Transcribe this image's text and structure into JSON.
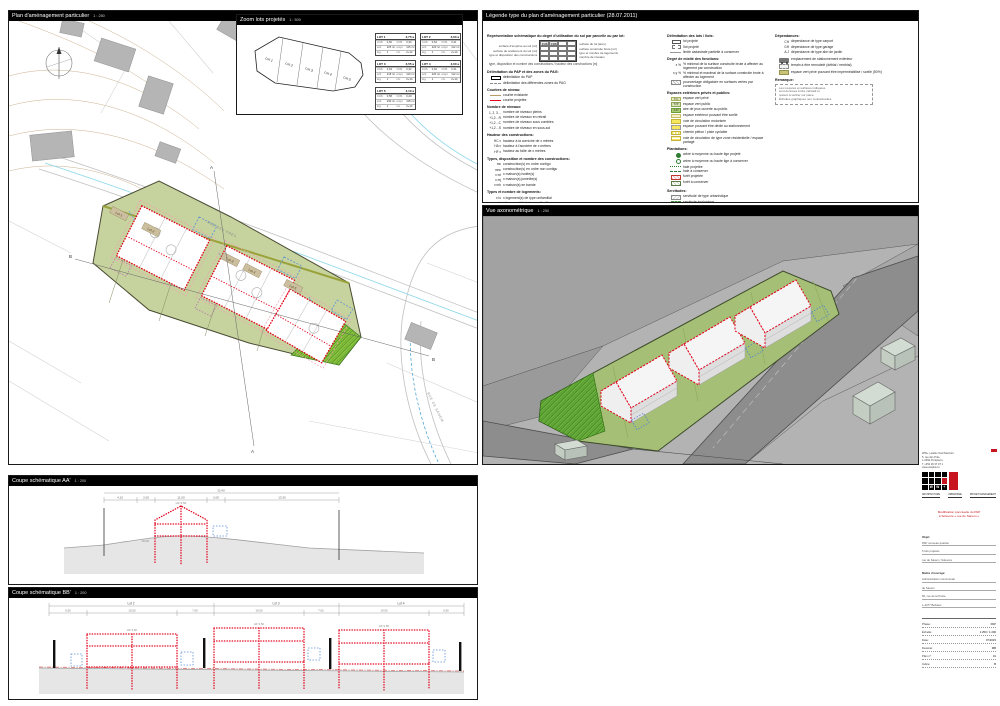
{
  "panels": {
    "plan": {
      "title": "Plan d'aménagement particulier",
      "scale": "1 : 250"
    },
    "zoom": {
      "title": "Zoom lots projetés",
      "scale": "1 : 500"
    },
    "legend": {
      "title": "Légende type du plan d'aménagement particulier (28.07.2011)"
    },
    "axo": {
      "title": "Vue axonométrique",
      "scale": "1 : 250"
    },
    "coupeA": {
      "title": "Coupe schématique AA'",
      "scale": "1 : 200"
    },
    "coupeB": {
      "title": "Coupe schématique BB'",
      "scale": "1 : 200"
    }
  },
  "plan": {
    "north": "N",
    "street_top": "RUE DES PRÉS",
    "street_right": "RUE DE SANEM",
    "lots": [
      "Lot 1",
      "Lot 2",
      "Lot 3",
      "Lot 4",
      "Lot 5"
    ],
    "sectionA": "A",
    "sectionB": "B"
  },
  "zoom_lots": {
    "labels": [
      "Lot 1",
      "Lot 2",
      "Lot 3",
      "Lot 4",
      "Lot 5"
    ]
  },
  "lot_tables": [
    {
      "title": "LOT 1",
      "area": "3,75 a",
      "rows": [
        [
          "CUS",
          "0,60",
          "COS",
          "0,30"
        ],
        [
          "scb",
          "225 m²",
          "empr.",
          "115 m²"
        ],
        [
          "log.",
          "1",
          "niv.",
          "2+1C"
        ]
      ]
    },
    {
      "title": "LOT 2",
      "area": "3,60 a",
      "rows": [
        [
          "CUS",
          "0,62",
          "COS",
          "0,31"
        ],
        [
          "scb",
          "220 m²",
          "empr.",
          "112 m²"
        ],
        [
          "log.",
          "1",
          "niv.",
          "2+1C"
        ]
      ]
    },
    {
      "title": "LOT 3",
      "area": "3,55 a",
      "rows": [
        [
          "CUS",
          "0,63",
          "COS",
          "0,32"
        ],
        [
          "scb",
          "218 m²",
          "empr.",
          "110 m²"
        ],
        [
          "log.",
          "1",
          "niv.",
          "2+1C"
        ]
      ]
    },
    {
      "title": "LOT 4",
      "area": "3,60 a",
      "rows": [
        [
          "CUS",
          "0,62",
          "COS",
          "0,31"
        ],
        [
          "scb",
          "220 m²",
          "empr.",
          "112 m²"
        ],
        [
          "log.",
          "1",
          "niv.",
          "2+1C"
        ]
      ]
    },
    {
      "title": "LOT 5",
      "area": "4,10 a",
      "rows": [
        [
          "CUS",
          "0,58",
          "COS",
          "0,29"
        ],
        [
          "scb",
          "230 m²",
          "empr.",
          "118 m²"
        ],
        [
          "log.",
          "1",
          "niv.",
          "2+1C"
        ]
      ]
    }
  ],
  "legend": {
    "columns": [
      [
        {
          "h": "Représentation schématique du degré d'utilisation du sol par parcelle ou par lot:",
          "table": {
            "left": [
              "surface d'emprise au sol [m²]",
              "surface de scellement du sol [m²]",
              "type et disposition des constructions"
            ],
            "right": [
              "surface du lot [ares]",
              "surface construite brute [m²]",
              "type et nombre de logements",
              "nombre de niveaux"
            ],
            "h1": "CUS",
            "h2": "COS"
          },
          "note": "type, disposition et nombre des constructions / hauteur des constructions [m]"
        },
        {
          "h": "Délimitation du PAP et des zones du PAG:",
          "items": [
            {
              "sw": "blackbox",
              "label": "délimitation du PAP"
            },
            {
              "sw": "graydash",
              "label": "délimitation des différentes zones du PAG"
            }
          ]
        },
        {
          "h": "Courbes de niveau:",
          "items": [
            {
              "sw": "tan",
              "label": "courbe existante"
            },
            {
              "sw": "red",
              "label": "courbe projetée"
            }
          ]
        },
        {
          "h": "Nombre de niveaux:",
          "items": [
            {
              "ab": "1, 2, 3…",
              "label": "nombre de niveaux pleins"
            },
            {
              "ab": "+1,2…R",
              "label": "nombre de niveaux en retrait"
            },
            {
              "ab": "+1,2…C",
              "label": "nombre de niveaux sous combles"
            },
            {
              "ab": "+1,2…S",
              "label": "nombre de niveaux en sous-sol"
            }
          ]
        },
        {
          "h": "Hauteur des constructions:",
          "items": [
            {
              "ab": "HC x",
              "label": "hauteur à la corniche de x mètres"
            },
            {
              "ab": "HA x",
              "label": "hauteur à l'acrotère de x mètres"
            },
            {
              "ab": "HF x",
              "label": "hauteur au faîte de x mètres"
            }
          ]
        },
        {
          "h": "Types, disposition et nombre des constructions:",
          "items": [
            {
              "ab": "mc",
              "label": "construction(s) en ordre contigu"
            },
            {
              "ab": "mnc",
              "label": "construction(s) en ordre non contigu"
            },
            {
              "ab": "x mi",
              "label": "x maison(s) isolée(s)"
            },
            {
              "ab": "x mj",
              "label": "x maison(s) jumelée(s)"
            },
            {
              "ab": "x mb",
              "label": "x maison(s) en bande"
            }
          ]
        },
        {
          "h": "Types et nombre de logements:",
          "items": [
            {
              "ab": "x lu",
              "label": "x logement(s) de type unifamilial"
            },
            {
              "ab": "x lc",
              "label": "x logement(s) de type collectif"
            },
            {
              "ab": "x ls",
              "label": "x logement(s) de type studio"
            }
          ]
        },
        {
          "h": "Formes de toiture:",
          "items": [
            {
              "ab": "tp",
              "label": "toiture plate"
            },
            {
              "ab": "tv (x°)",
              "label": "toiture à versants, degré d'inclinaison"
            },
            {
              "sw": "arrow",
              "label": "orientation du faîte"
            }
          ]
        },
        {
          "h": "Gabarit des immeubles (plan / coupe):",
          "items": [
            {
              "sw": "reddot",
              "label": "alignement obligatoire pour constructions destinées au séjour prolongé"
            },
            {
              "sw": "reddash",
              "label": "limite de surfaces constructibles pour constructions destinées au séjour prolongé"
            },
            {
              "sw": "bluedot",
              "label": "alignement obligatoire pour dépendances"
            },
            {
              "sw": "bluedash",
              "label": "limite de surfaces constructibles pour dépendances"
            },
            {
              "sw": "purpledash",
              "label": "limite de surfaces constructibles pour constructions souterraines"
            },
            {
              "sw": "darkdash",
              "label": "limite de surfaces constructibles pour avant-corps"
            }
          ]
        }
      ],
      [
        {
          "h": "Délimitation des lots / îlots:",
          "items": [
            {
              "sw": "lot",
              "label": "lot projeté"
            },
            {
              "sw": "ilot",
              "label": "îlot projeté"
            },
            {
              "sw": "cad",
              "label": "limite cadastrale partielle à conserver"
            }
          ]
        },
        {
          "h": "Degré de mixité des fonctions:",
          "items": [
            {
              "ab": "x %",
              "label": "% minimal de la surface construite brute à affecter au logement par construction"
            },
            {
              "ab": "x-y %",
              "label": "% minimal et maximal de la surface construite brute à affecter au logement"
            },
            {
              "sw": "hatchy",
              "label": "pourcentage obligatoire en surfaces vertes par construction"
            }
          ]
        },
        {
          "h": "Espaces extérieurs privés et publics:",
          "items": [
            {
              "sw": "box sw-tvj",
              "ab2": "TVJ",
              "label": "espace vert privé"
            },
            {
              "sw": "box sw-tvp",
              "ab2": "TVP",
              "label": "espace vert public"
            },
            {
              "sw": "box sw-ajo",
              "ab2": "AJO",
              "label": "aire de jeux ouverte au public"
            },
            {
              "sw": "box sw-scel",
              "label": "espace extérieur pouvant être scellé"
            },
            {
              "sw": "box sw-voie",
              "label": "voie de circulation motorisée"
            },
            {
              "sw": "box sw-pieton",
              "label": "espace pouvant être dédié au stationnement"
            },
            {
              "sw": "box sw-chem",
              "label": "chemin piéton / piste cyclable"
            },
            {
              "sw": "box sw-zoneres",
              "label": "voie de circulation de type zone résidentielle / espace partagé"
            }
          ]
        },
        {
          "h": "Plantations:",
          "items": [
            {
              "sw": "treep",
              "label": "arbre à moyenne ou haute tige projeté"
            },
            {
              "sw": "treec",
              "label": "arbre à moyenne ou haute tige à conserver"
            },
            {
              "sw": "haiep",
              "label": "haie projetée"
            },
            {
              "sw": "haiec",
              "label": "haie à conserver"
            },
            {
              "sw": "foretp",
              "label": "forêt projetée"
            },
            {
              "sw": "foretc",
              "label": "forêt à conserver"
            }
          ]
        },
        {
          "h": "Servitudes:",
          "items": [
            {
              "sw": "servurb",
              "label": "servitude de type urbanistique"
            },
            {
              "sw": "servec",
              "label": "servitude écologique"
            },
            {
              "sw": "servpass",
              "label": "servitude de passage"
            },
            {
              "sw": "reddotpt",
              "label": "élément bâti ou naturel à sauvegarder"
            }
          ]
        },
        {
          "h": "Infrastructures techniques:",
          "items": [
            {
              "ab": "CE / CR",
              "label": "identification à titre exemplatif des réseaux"
            },
            {
              "sw": "canalp",
              "label": "canalisation pour eaux pluviales"
            },
            {
              "sw": "canalu",
              "label": "canalisation pour eaux usées"
            },
            {
              "sw": "canalm",
              "label": "canalisation pour eaux mixtes"
            },
            {
              "sw": "fosse",
              "label": "fossé ouvert pour eaux pluviales"
            }
          ]
        },
        {
          "h": "2. Éléments complémentaires à la légende-type selon règlement grand-ducal du 28 juillet 2011 concernant le contenu du plan d'aménagement particulier « nouveau quartier »:",
          "items": [
            {
              "sw": "fossex",
              "label": "fossé existant"
            },
            {
              "sw": "canalpx",
              "label": "canalisation pour eaux pluviales existante"
            },
            {
              "sw": "canalux",
              "label": "canalisation pour eaux usées existante"
            },
            {
              "sw": "canalmx",
              "label": "canalisation pour eaux mixtes existante"
            },
            {
              "sw": "terrasse",
              "label": "limite de surfaces constructibles pour terrasses"
            }
          ]
        }
      ],
      [
        {
          "h": "Dépendances:",
          "items": [
            {
              "ab": "CH",
              "label": "dépendance de type carport"
            },
            {
              "ab": "GH",
              "label": "dépendance de type garage"
            },
            {
              "ab": "A.J",
              "label": "dépendance de type abri de jardin"
            }
          ]
        },
        {
          "h": "",
          "items": [
            {
              "sw": "car",
              "label": "emplacement de stationnement extérieur"
            },
            {
              "sw": "remblai",
              "label": "terrain à être remodelé (déblai / remblai)"
            },
            {
              "sw": "olive",
              "label": "espace vert privé pouvant être imperméabilisé / scellé (50%)"
            }
          ]
        },
        {
          "h": "Remarque:",
          "box": [
            "Les mesures et surfaces indiquées",
            "sont données à titre indicatif et",
            "restent à vérifier sur place.",
            "Échelles graphiques non contractuelles."
          ]
        }
      ]
    ]
  },
  "coupeA": {
    "total": "32,40",
    "dims": [
      "4,10",
      "2,00",
      "11,00",
      "2,00",
      "13,30"
    ],
    "height": "HF 9,50",
    "base": "±0,00"
  },
  "coupeB": {
    "lots": [
      "Lot 2",
      "Lot 3",
      "Lot 4"
    ],
    "dims": [
      "6,50",
      "19,50",
      "7,00",
      "19,50",
      "7,00",
      "19,50",
      "6,50"
    ],
    "height": "HF 9,50"
  },
  "titleblock": {
    "firm_lines": [
      "WW+ | atelier d'architecture",
      "5, rue des Prés",
      "L-4392 Pontpierre",
      "T +352 26 37 07 1",
      "www.wwplus.lu"
    ],
    "logo_letters": [
      "W",
      "W",
      "+"
    ],
    "words": [
      "ARCHITECTURE",
      "URBANISME",
      "PROJET MANAGEMENT"
    ],
    "red_lines": [
      "Modification ponctuelle du PAP",
      "à Soleuvre « rue de Sanem »"
    ],
    "sections": [
      {
        "label": "Objet:",
        "lines": [
          "PAP nouveau quartier",
          "5 lots projetés",
          "rue de Sanem, Soleuvre"
        ]
      },
      {
        "label": "Maître d'ouvrage:",
        "lines": [
          "Administration communale",
          "de Sanem",
          "60, rue de la Poste",
          "L-4477 Belvaux"
        ]
      }
    ],
    "rows": [
      {
        "l": "Phase:",
        "v": "PAP"
      },
      {
        "l": "Échelle:",
        "v": "1:250 / 1:200"
      },
      {
        "l": "Date:",
        "v": "07/2023"
      },
      {
        "l": "Dessiné:",
        "v": "MB"
      },
      {
        "l": "Plan n°:",
        "v": "01"
      },
      {
        "l": "Indice:",
        "v": "B"
      }
    ]
  }
}
